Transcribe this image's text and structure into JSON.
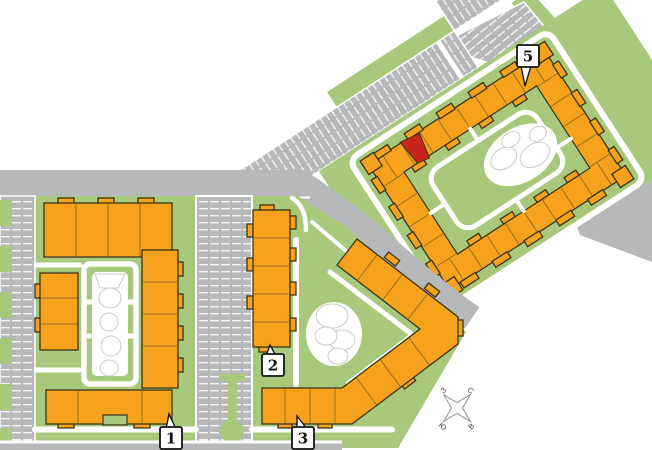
{
  "map": {
    "labels": [
      {
        "id": "building-1",
        "text": "1"
      },
      {
        "id": "building-2",
        "text": "2"
      },
      {
        "id": "building-3",
        "text": "3"
      },
      {
        "id": "building-5",
        "text": "5"
      }
    ],
    "compass": {
      "north": "С",
      "east": "В",
      "south": "Ю",
      "west": "З"
    },
    "highlighted_unit": {
      "building": "5"
    },
    "colors": {
      "building": "#F6A21C",
      "building-outline": "#3B3418",
      "highlighted-unit": "#C9241C",
      "greenery": "#A8C87C",
      "road": "#B6B8BA",
      "path": "#FFFFFF",
      "blob-outline": "#C8CDC4"
    }
  }
}
